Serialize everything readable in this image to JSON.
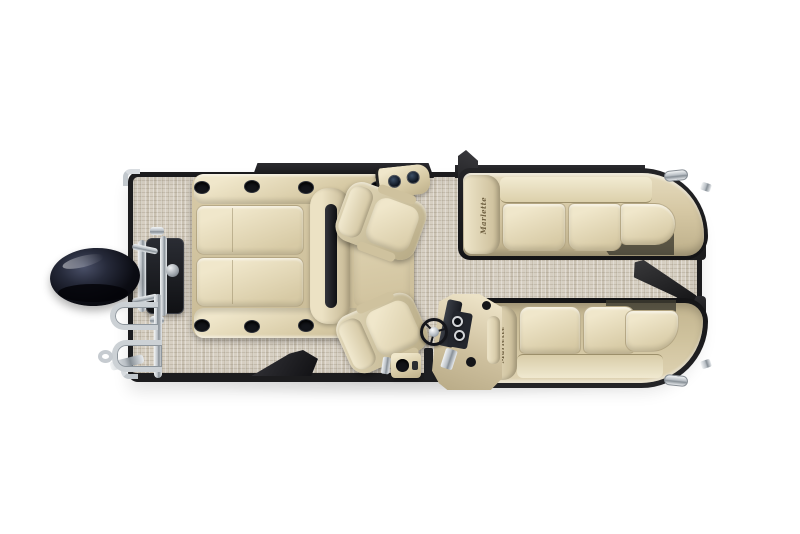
{
  "meta": {
    "description": "Overhead floor-plan rendering of a Marlette pontoon boat: black outboard motor and chrome boarding ladder at the stern, beige woven deck, back-to-back bench seat with cup-holder armrests, two swiveling captain's chairs, starboard helm console with steering wheel and gauges, and two wrap-around tan bow lounges with open bow and side gates",
    "canvas_width": 800,
    "canvas_height": 534,
    "background": "#ffffff"
  },
  "brand": {
    "logo_text": "Marlette"
  },
  "colors": {
    "carpet": "#d2cabb",
    "carpet_line": "#b7ad9a",
    "seat_hi": "#f0e7cb",
    "seat_mid": "#d7caa5",
    "seat_lo": "#bdaf8a",
    "seam": "#9c8f6a",
    "rail": "#1c1c1e",
    "chrome_hi": "#f2f4f5",
    "chrome_lo": "#878f96",
    "motor_black": "#0b0c13",
    "dash": "#23262d",
    "shadow": "#3f3c31"
  },
  "parts": {
    "deck": "Woven vinyl deck flooring",
    "outboard_motor": "Outboard motor",
    "motor_mount": "Motor mount bracket",
    "boarding_ladder": "Stern boarding ladder",
    "back_to_back_seat": "Back-to-back bench seat",
    "armrest_cupholder": "Armrest cup holder",
    "cup_holder_console": "Cup holder console",
    "captain_chair": "Captain's chair",
    "helm_chair": "Helm chair",
    "helm_console": "Helm console",
    "steering_wheel": "Steering wheel",
    "gauge": "Helm gauge",
    "port_bow_lounge": "Port bow lounge",
    "starboard_bow_lounge": "Starboard bow lounge",
    "bow_gate": "Bow gate (open)",
    "side_gate": "Side gate (open)",
    "stern_corner_trim": "Chrome corner trim",
    "bow_cleat": "Chrome cleat"
  }
}
